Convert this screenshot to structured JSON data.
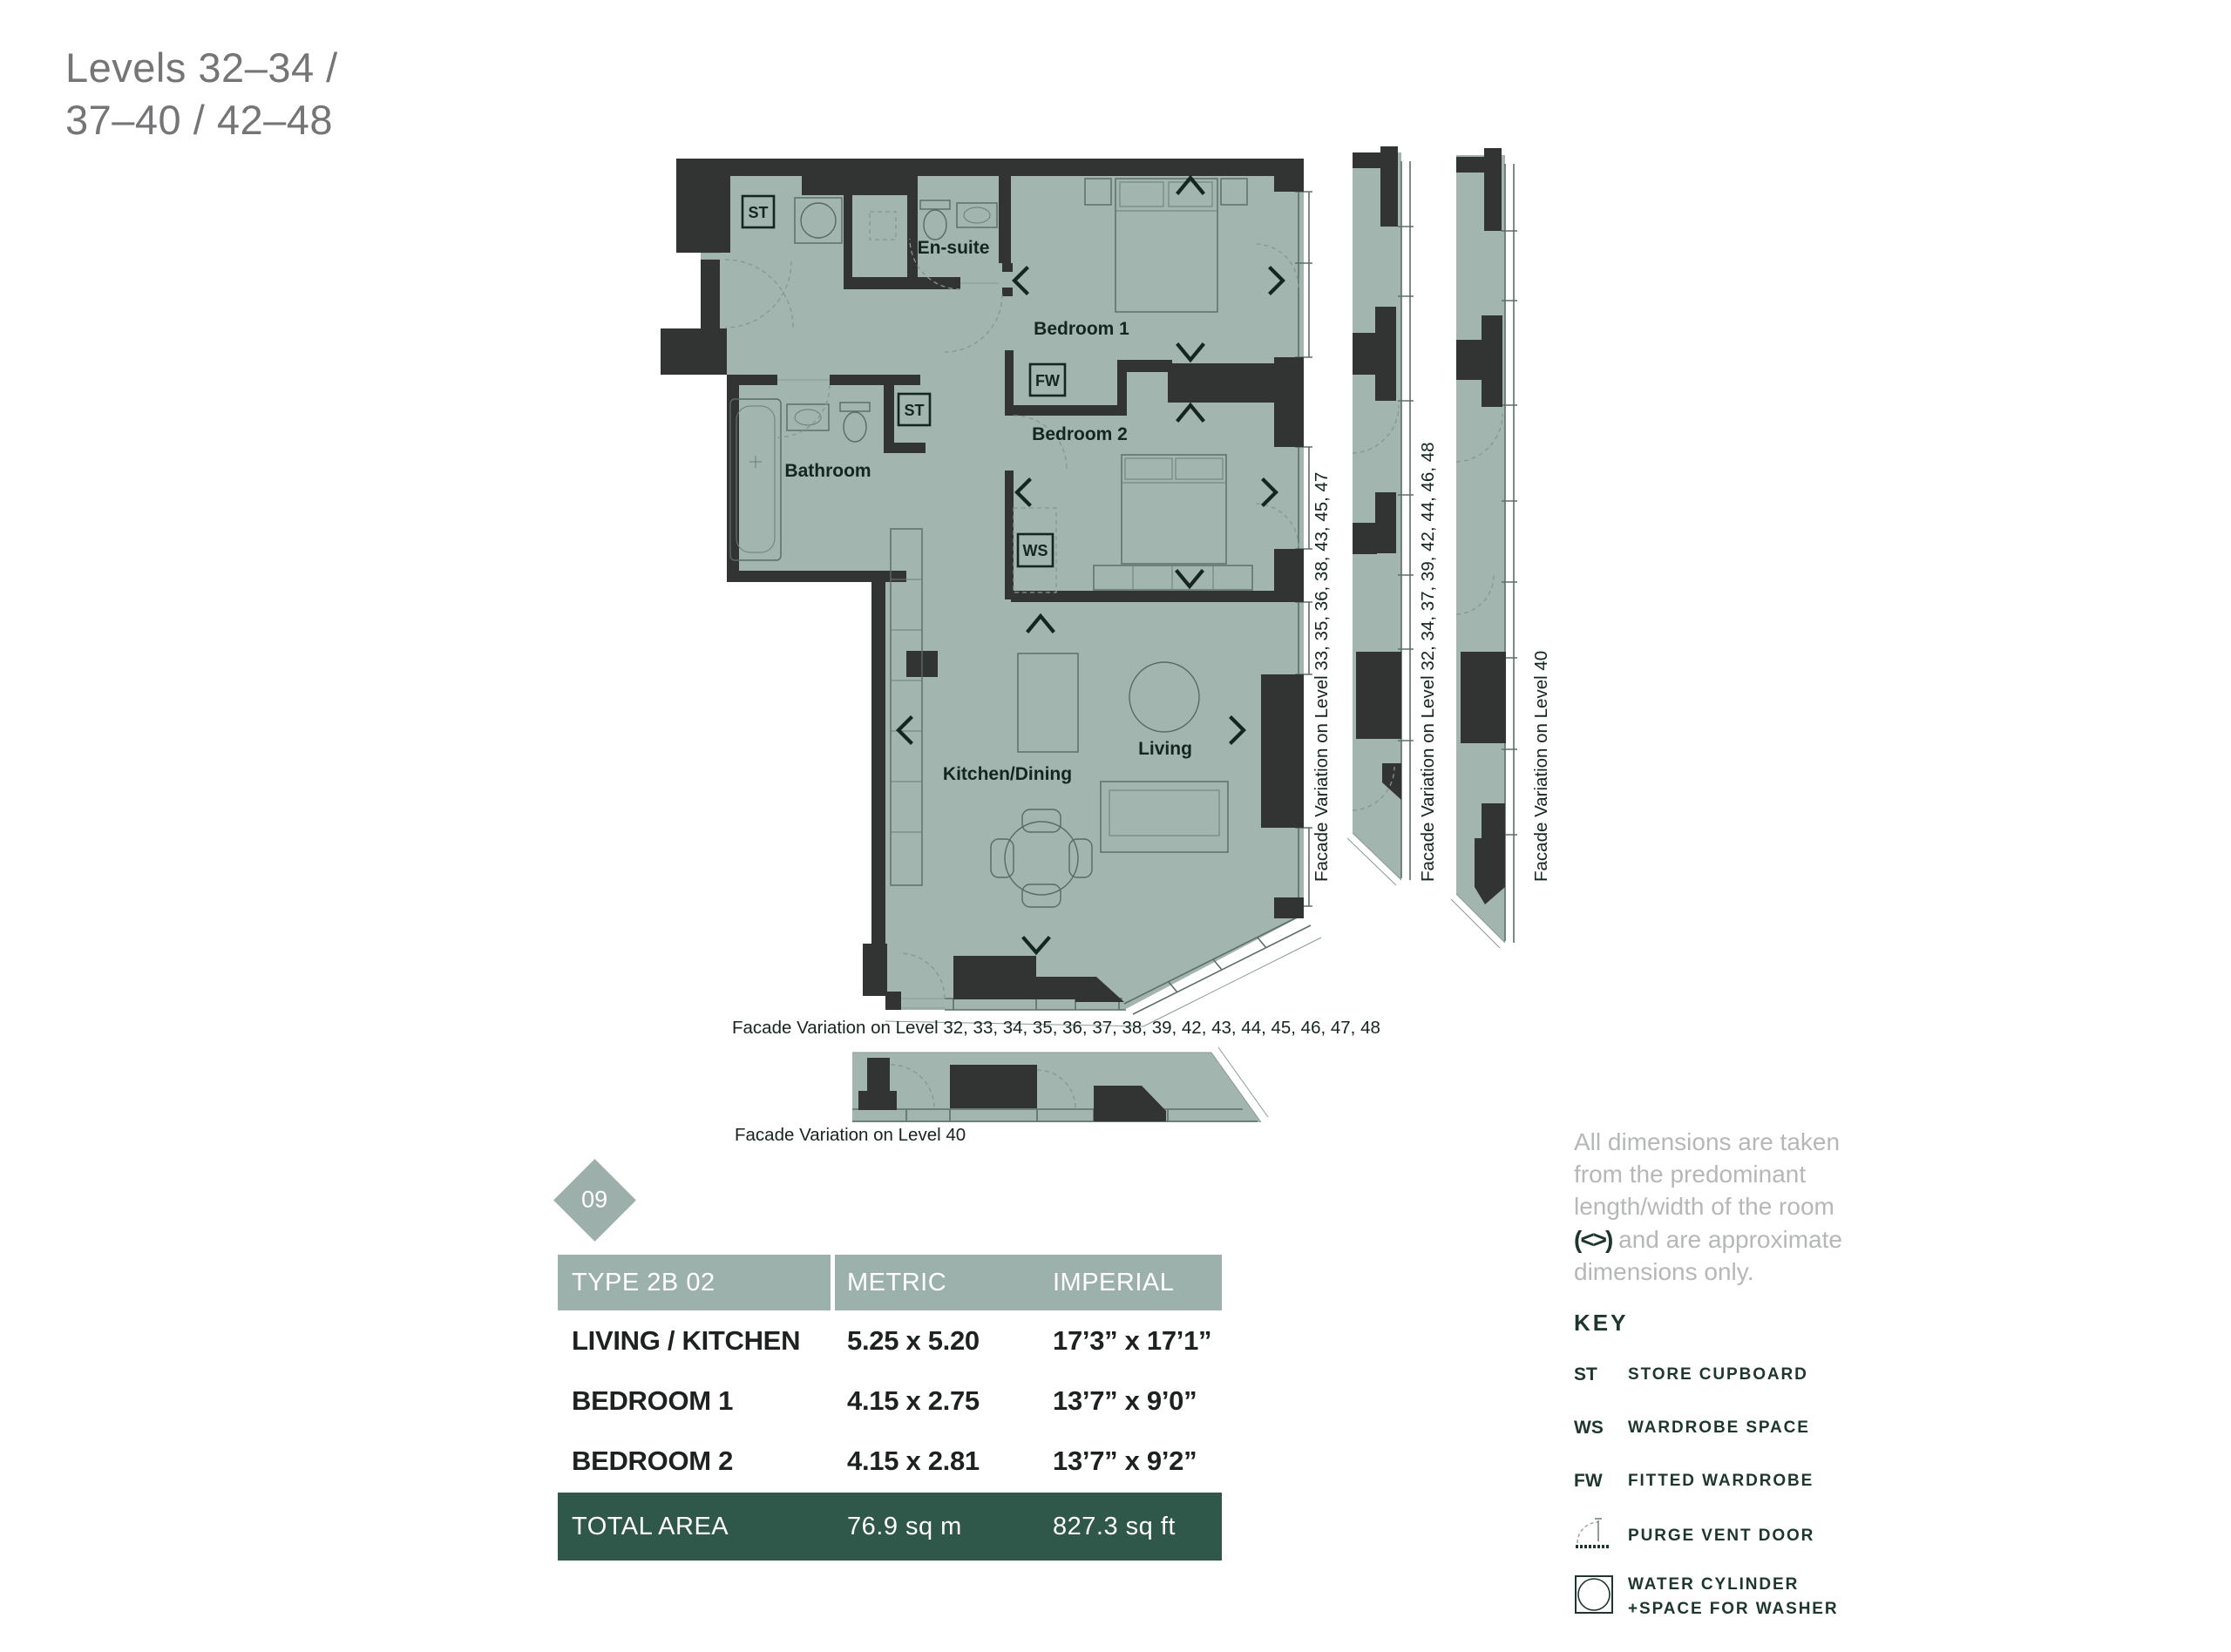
{
  "title": {
    "line1": "Levels 32–34 /",
    "line2": "37–40 / 42–48"
  },
  "plan": {
    "labels": {
      "st1": "ST",
      "st2": "ST",
      "fw": "FW",
      "ws": "WS",
      "ensuite": "En-suite",
      "bedroom1": "Bedroom 1",
      "bedroom2": "Bedroom 2",
      "bathroom": "Bathroom",
      "living": "Living",
      "kitchen": "Kitchen/Dining"
    },
    "captions": {
      "main_bottom": "Facade Variation on Level 32, 33, 34, 35, 36, 37, 38, 39, 42, 43, 44, 45, 46, 47, 48",
      "strip_bottom": "Facade Variation on Level 40",
      "side1": "Facade Variation on Level 33, 35, 36, 38, 43, 45, 47",
      "side2": "Facade Variation on Level 32, 34, 37, 39, 42, 44, 46, 48",
      "side3": "Facade Variation on Level 40"
    }
  },
  "badge": {
    "number": "09"
  },
  "table": {
    "header": [
      "TYPE 2B 02",
      "METRIC",
      "IMPERIAL"
    ],
    "rows": [
      {
        "name": "LIVING / KITCHEN",
        "metric": "5.25 x 5.20",
        "imperial": "17’3” x 17’1”"
      },
      {
        "name": "BEDROOM 1",
        "metric": "4.15 x 2.75",
        "imperial": "13’7” x 9’0”"
      },
      {
        "name": "BEDROOM 2",
        "metric": "4.15 x 2.81",
        "imperial": "13’7” x 9’2”"
      }
    ],
    "total": {
      "name": "TOTAL AREA",
      "metric": "76.9 sq m",
      "imperial": "827.3 sq ft"
    }
  },
  "note": {
    "text1": "All dimensions are taken from the predominant length/width of the room ",
    "symbol": "(<>)",
    "text2": " and are approximate dimensions only."
  },
  "key": {
    "title": "KEY",
    "items": [
      {
        "abbr": "ST",
        "label": "STORE CUPBOARD"
      },
      {
        "abbr": "WS",
        "label": "WARDROBE SPACE"
      },
      {
        "abbr": "FW",
        "label": "FITTED WARDROBE"
      },
      {
        "abbr": "",
        "label": "PURGE VENT DOOR"
      },
      {
        "abbr": "",
        "label": "WATER CYLINDER",
        "label2": "+SPACE FOR WASHER"
      }
    ]
  },
  "colors": {
    "plan_fill": "#a2b5af",
    "wall": "#313432",
    "table_header_bg": "#9cb1ac",
    "total_row_bg": "#2f574a",
    "badge_bg": "#9cafaa",
    "key_text": "#1d362e",
    "note_text": "#b5b8b7",
    "title_text": "#757577",
    "plan_text": "#15251f"
  }
}
